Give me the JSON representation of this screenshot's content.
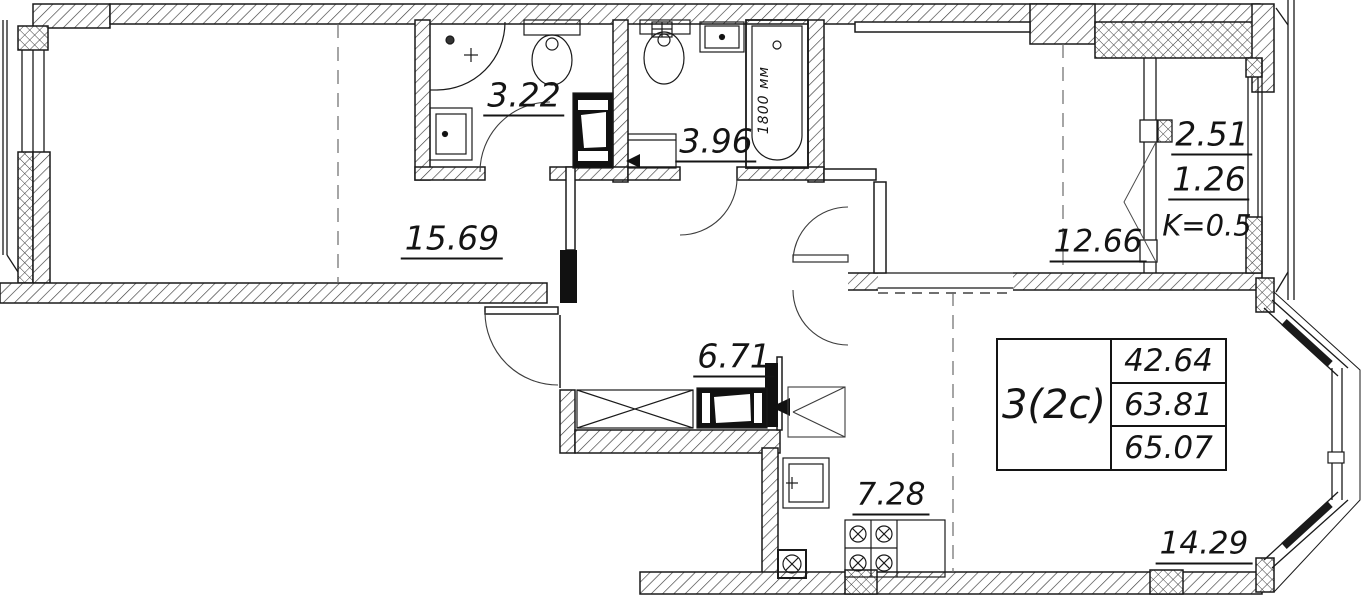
{
  "plan": {
    "unit": {
      "type_label": "3(2с)",
      "areas": [
        "42.64",
        "63.81",
        "65.07"
      ]
    },
    "rooms": {
      "room1": "15.69",
      "bath1": "3.22",
      "bath2": "3.96",
      "room2": "12.66",
      "hall": "6.71",
      "kitchen": "7.28",
      "living": "14.29"
    },
    "balcony": {
      "area": "2.51",
      "reduced": "1.26",
      "coefficient": "K=0.5"
    },
    "bathtub_dimension": "1800 мм",
    "line_color": "#1a1a1a"
  }
}
